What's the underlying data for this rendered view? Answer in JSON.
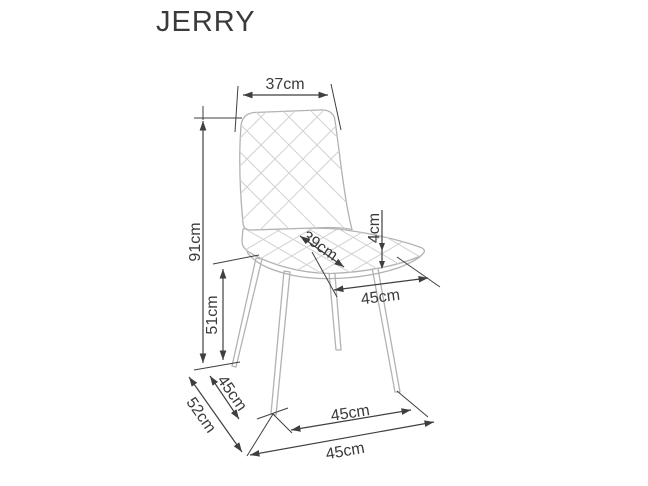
{
  "title": "JERRY",
  "colors": {
    "background": "#ffffff",
    "dimension_lines": "#3f3f3f",
    "chair_outline": "#b2b2b2",
    "quilt_lines": "#d2d2d2",
    "label_text": "#3a3a3a"
  },
  "dimensions": {
    "backrest_width": {
      "label": "37cm"
    },
    "total_height": {
      "label": "91cm"
    },
    "seat_height": {
      "label": "51cm"
    },
    "seat_depth": {
      "label": "39cm"
    },
    "cushion_thickness": {
      "label": "4cm"
    },
    "seat_width": {
      "label": "45cm"
    },
    "side_leg_span": {
      "label": "45cm"
    },
    "total_depth": {
      "label": "52cm"
    },
    "front_leg_span": {
      "label": "45cm"
    },
    "base_width": {
      "label": "45cm"
    }
  }
}
